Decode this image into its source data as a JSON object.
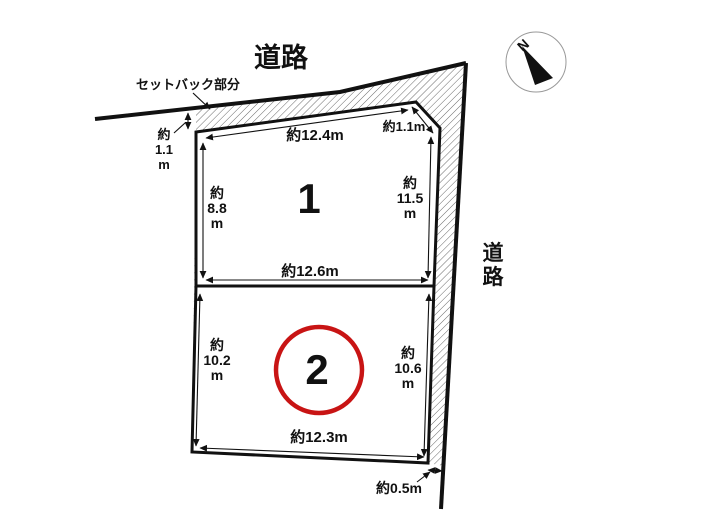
{
  "roads": {
    "top_label": "道路",
    "right_char_1": "道",
    "right_char_2": "路"
  },
  "setback": {
    "label": "セットバック部分",
    "width_line1": "約",
    "width_line2": "1.1",
    "width_line3": "m"
  },
  "north_label": "N",
  "plots": [
    {
      "number": "1",
      "dims": {
        "top": "約12.4m",
        "left": [
          "約",
          "8.8",
          "m"
        ],
        "right": [
          "約",
          "11.5",
          "m"
        ],
        "bottom": "約12.6m"
      },
      "corner_cut": "約1.1m"
    },
    {
      "number": "2",
      "dims": {
        "left": [
          "約",
          "10.2",
          "m"
        ],
        "right": [
          "約",
          "10.6",
          "m"
        ],
        "bottom": "約12.3m"
      },
      "bottom_gap": "約0.5m"
    }
  ],
  "colors": {
    "highlight_circle": "#c81414",
    "line": "#111111"
  }
}
